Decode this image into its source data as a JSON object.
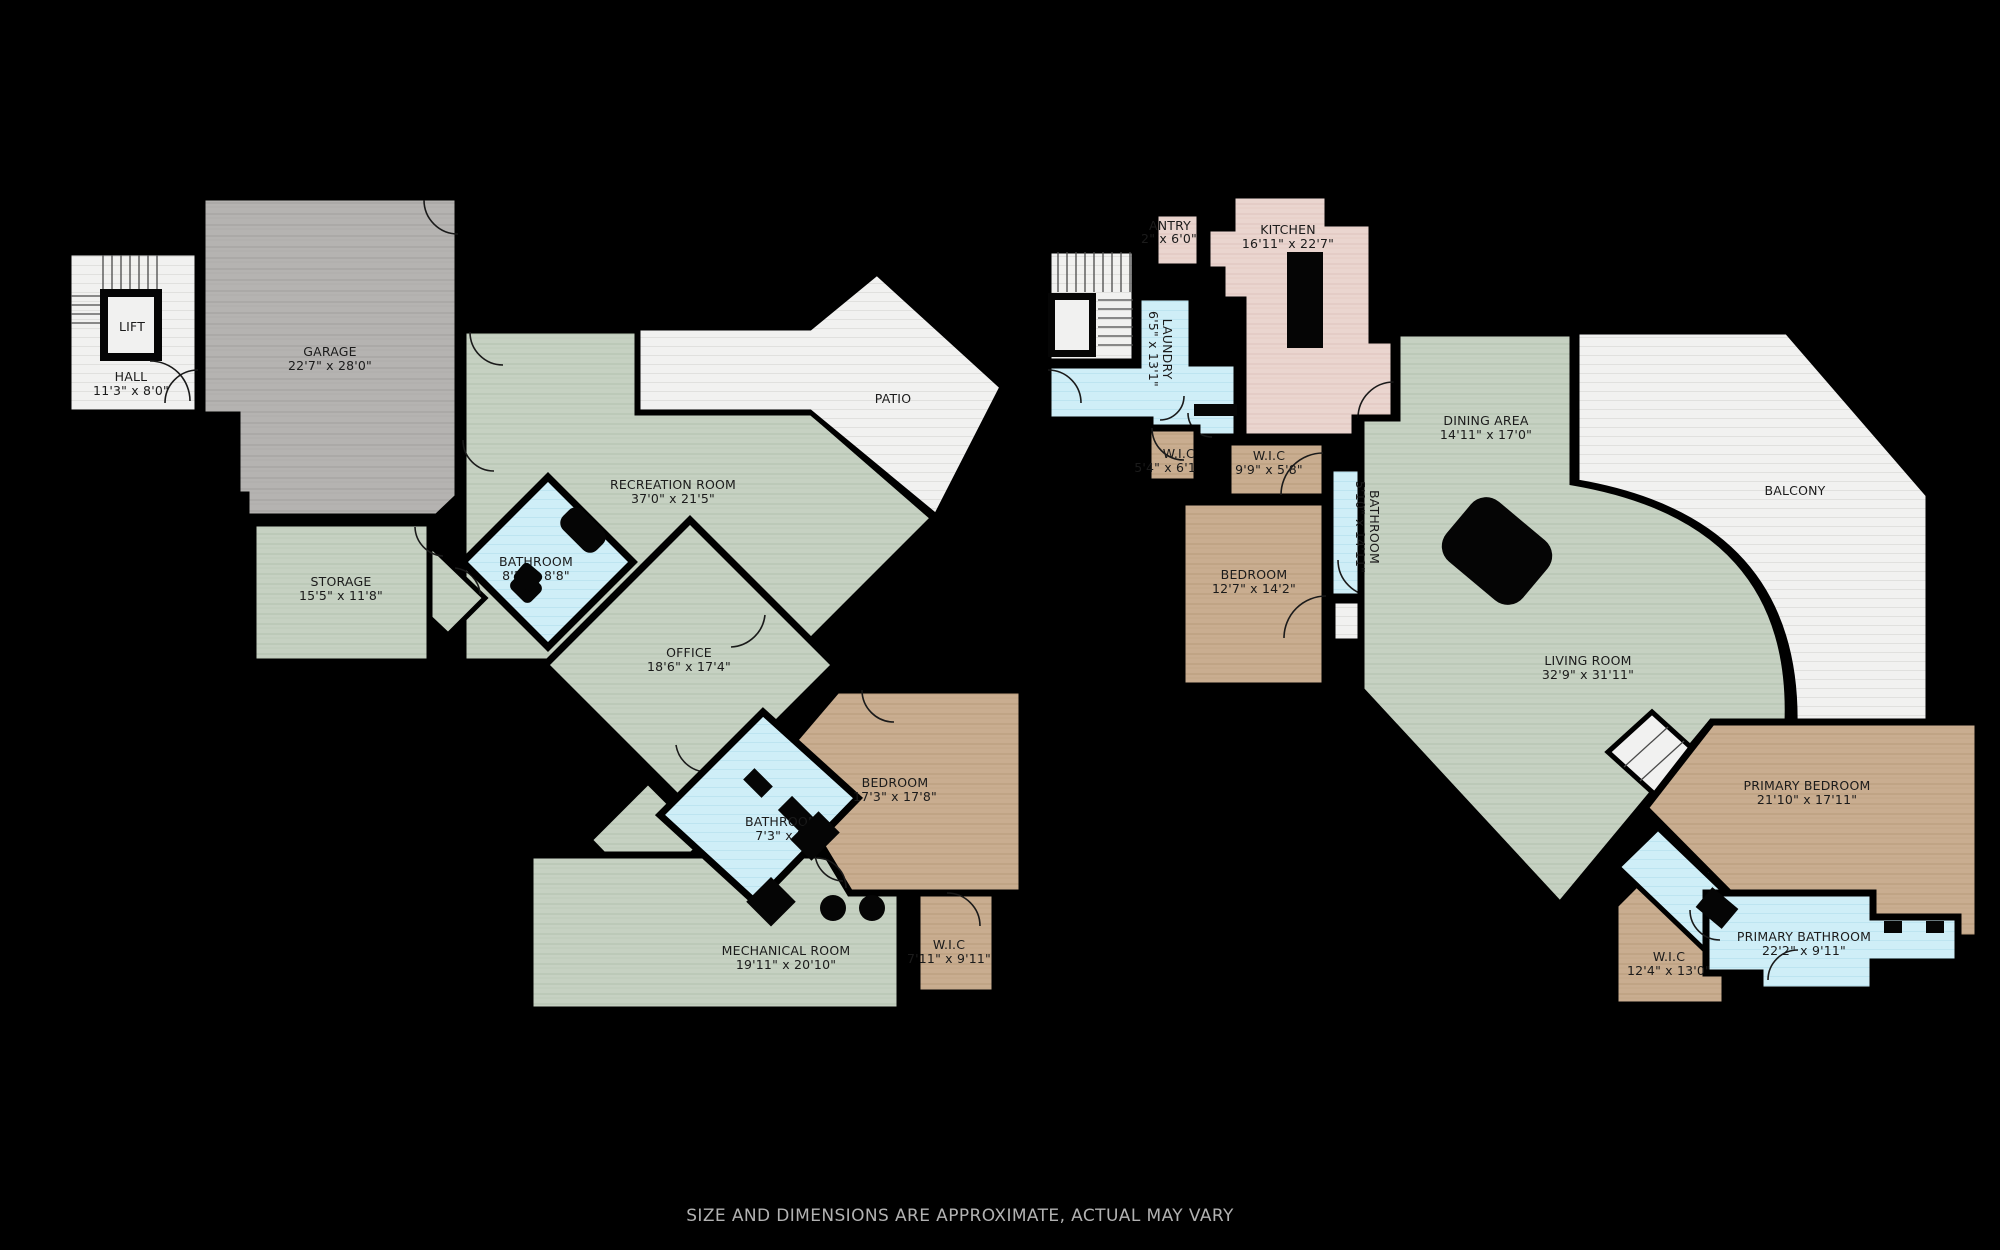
{
  "disclaimer": "SIZE AND DIMENSIONS ARE APPROXIMATE, ACTUAL MAY VARY",
  "palette": {
    "background": "#000000",
    "wood_green": "#c6d1c2",
    "garage_grey": "#b5b3b1",
    "bedroom_tan": "#c9ad90",
    "bath_blue": "#cfeef7",
    "kitchen_pink": "#ead5cf",
    "outdoor_white": "#f1f1f0"
  },
  "floor1": {
    "lift": {
      "label": "LIFT"
    },
    "hall": {
      "label": "HALL",
      "dims": "11'3\" x 8'0\""
    },
    "garage": {
      "label": "GARAGE",
      "dims": "22'7\" x 28'0\""
    },
    "recreation": {
      "label": "RECREATION ROOM",
      "dims": "37'0\" x 21'5\""
    },
    "patio": {
      "label": "PATIO"
    },
    "storage": {
      "label": "STORAGE",
      "dims": "15'5\" x 11'8\""
    },
    "bathroom1": {
      "label": "BATHROOM",
      "dims": "8'2\" x 8'8\""
    },
    "office": {
      "label": "OFFICE",
      "dims": "18'6\" x 17'4\""
    },
    "bedroom": {
      "label": "BEDROOM",
      "dims": "17'3\" x 17'8\""
    },
    "bathroom2": {
      "label": "BATHROOM",
      "dims": "7'3\" x 7'"
    },
    "mechanical": {
      "label": "MECHANICAL ROOM",
      "dims": "19'11\" x 20'10\""
    },
    "wic": {
      "label": "W.I.C",
      "dims": "7'11\" x 9'11\""
    }
  },
  "floor2": {
    "pantry": {
      "label": "ANTRY",
      "dims": "2\" x 6'0\""
    },
    "kitchen": {
      "label": "KITCHEN",
      "dims": "16'11\" x 22'7\""
    },
    "laundry": {
      "label": "LAUNDRY",
      "dims": "6'5\" x 13'1\""
    },
    "wic_small": {
      "label": "W.I.C",
      "dims": "5'4\" x 6'1"
    },
    "wic_2": {
      "label": "W.I.C",
      "dims": "9'9\" x 5'8\""
    },
    "bathroom": {
      "label": "BATHROOM",
      "dims": "5'10\" x 14'11\""
    },
    "bedroom": {
      "label": "BEDROOM",
      "dims": "12'7\" x 14'2\""
    },
    "dining": {
      "label": "DINING AREA",
      "dims": "14'11\" x 17'0\""
    },
    "balcony": {
      "label": "BALCONY"
    },
    "living": {
      "label": "LIVING ROOM",
      "dims": "32'9\" x 31'11\""
    },
    "primary_bedroom": {
      "label": "PRIMARY BEDROOM",
      "dims": "21'10\" x 17'11\""
    },
    "primary_bathroom": {
      "label": "PRIMARY BATHROOM",
      "dims": "22'2\" x 9'11\""
    },
    "wic_3": {
      "label": "W.I.C",
      "dims": "12'4\" x 13'0\""
    }
  }
}
